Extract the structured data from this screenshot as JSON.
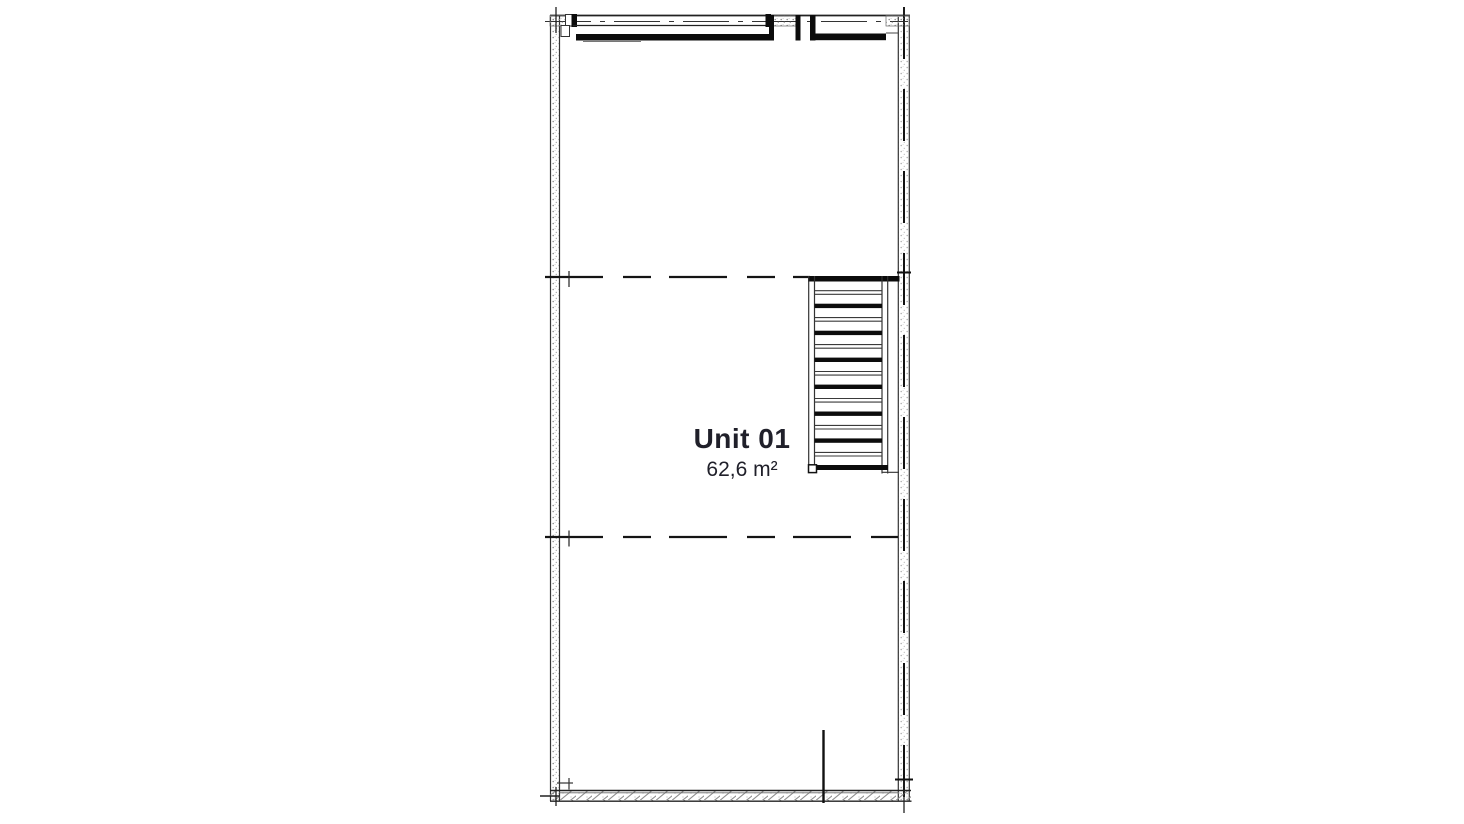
{
  "unit": {
    "label": "Unit 01",
    "area": "62,6 m²"
  },
  "staircase": {
    "visible_treads": 7
  },
  "colors": {
    "line": "#222222",
    "ink": "#0c0c0c",
    "hatch": "#999999",
    "text": "#20202a",
    "background": "#ffffff"
  }
}
